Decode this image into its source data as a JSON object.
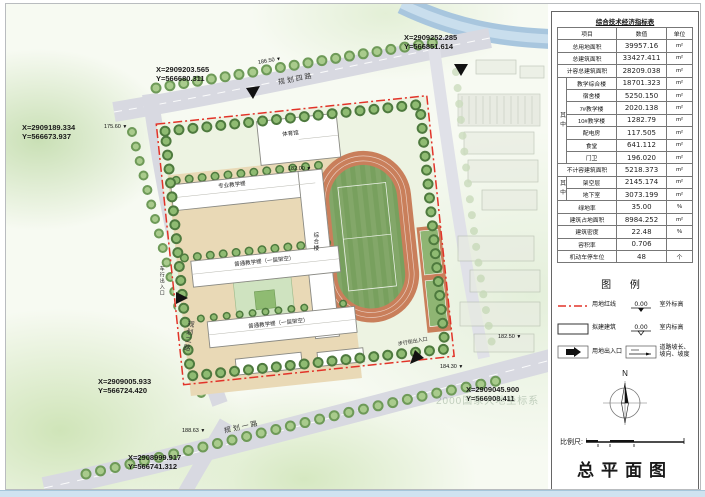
{
  "drawing_title": "总平面图",
  "table": {
    "title": "综合技术经济指标表",
    "headers": [
      "项目",
      "数值",
      "单位"
    ],
    "group1_label": "其中",
    "group2_label": "其中",
    "rows": [
      {
        "label": "总用地面积",
        "value": "39957.16",
        "unit": "m²"
      },
      {
        "label": "总建筑面积",
        "value": "33427.411",
        "unit": "m²"
      },
      {
        "label": "计容总建筑面积",
        "value": "28209.038",
        "unit": "m²"
      },
      {
        "label": "教学综合楼",
        "value": "18701.323",
        "unit": "m²"
      },
      {
        "label": "宿舍楼",
        "value": "5250.150",
        "unit": "m²"
      },
      {
        "label": "7#教学楼",
        "value": "2020.138",
        "unit": "m²"
      },
      {
        "label": "10#教学楼",
        "value": "1282.79",
        "unit": "m²"
      },
      {
        "label": "配电房",
        "value": "117.505",
        "unit": "m²"
      },
      {
        "label": "食堂",
        "value": "641.112",
        "unit": "m²"
      },
      {
        "label": "门卫",
        "value": "196.020",
        "unit": "m²"
      },
      {
        "label": "不计容建筑面积",
        "value": "5218.373",
        "unit": "m²"
      },
      {
        "label": "架空层",
        "value": "2145.174",
        "unit": "m²"
      },
      {
        "label": "地下室",
        "value": "3073.199",
        "unit": "m²"
      },
      {
        "label": "绿地率",
        "value": "35.00",
        "unit": "%"
      },
      {
        "label": "建筑占地面积",
        "value": "8984.252",
        "unit": "m²"
      },
      {
        "label": "建筑密度",
        "value": "22.48",
        "unit": "%"
      },
      {
        "label": "容积率",
        "value": "0.706",
        "unit": ""
      },
      {
        "label": "机动车停车位",
        "value": "48",
        "unit": "个"
      }
    ]
  },
  "legend": {
    "title": "图 例",
    "items": [
      {
        "label": "用地红线"
      },
      {
        "label": "拟建建筑"
      },
      {
        "label": "用地出入口"
      },
      {
        "label": "室外标高",
        "value": "0.00"
      },
      {
        "label": "室内标高",
        "value": "0.00"
      },
      {
        "label": "道路坡长、坡向、坡度"
      }
    ]
  },
  "compass": {
    "label": "N"
  },
  "scale": {
    "label": "比例尺:"
  },
  "plan": {
    "coordinates": [
      {
        "x": "X=2909252.285",
        "y": "Y=566851.614"
      },
      {
        "x": "X=2909203.565",
        "y": "Y=566680.311"
      },
      {
        "x": "X=2909189.334",
        "y": "Y=566673.937"
      },
      {
        "x": "X=2909005.933",
        "y": "Y=566724.420"
      },
      {
        "x": "X=2908999.917",
        "y": "Y=566741.312"
      },
      {
        "x": "X=2909045.900",
        "y": "Y=566908.411"
      }
    ],
    "roads": [
      "规划四路",
      "规划二路",
      "规划一路"
    ],
    "buildings": [
      "体育馆",
      "专业教学楼",
      "综合楼",
      "普通教学楼（一层架空）",
      "普通教学楼（一层架空）"
    ],
    "entrances": [
      "车行出入口",
      "步行街出入口"
    ],
    "elevations": [
      "175.60",
      "186.50",
      "182.00",
      "182.50",
      "184.30",
      "188.63"
    ],
    "watermark": "2000国家大地坐标系"
  },
  "colors": {
    "redline": "#e23329",
    "track": "#c97f5b",
    "field": "#83a769",
    "road": "#d8d9e1",
    "river": "#a8c6de",
    "tree_dark": "#4e7a3e",
    "tree_light": "#8fbb72"
  }
}
